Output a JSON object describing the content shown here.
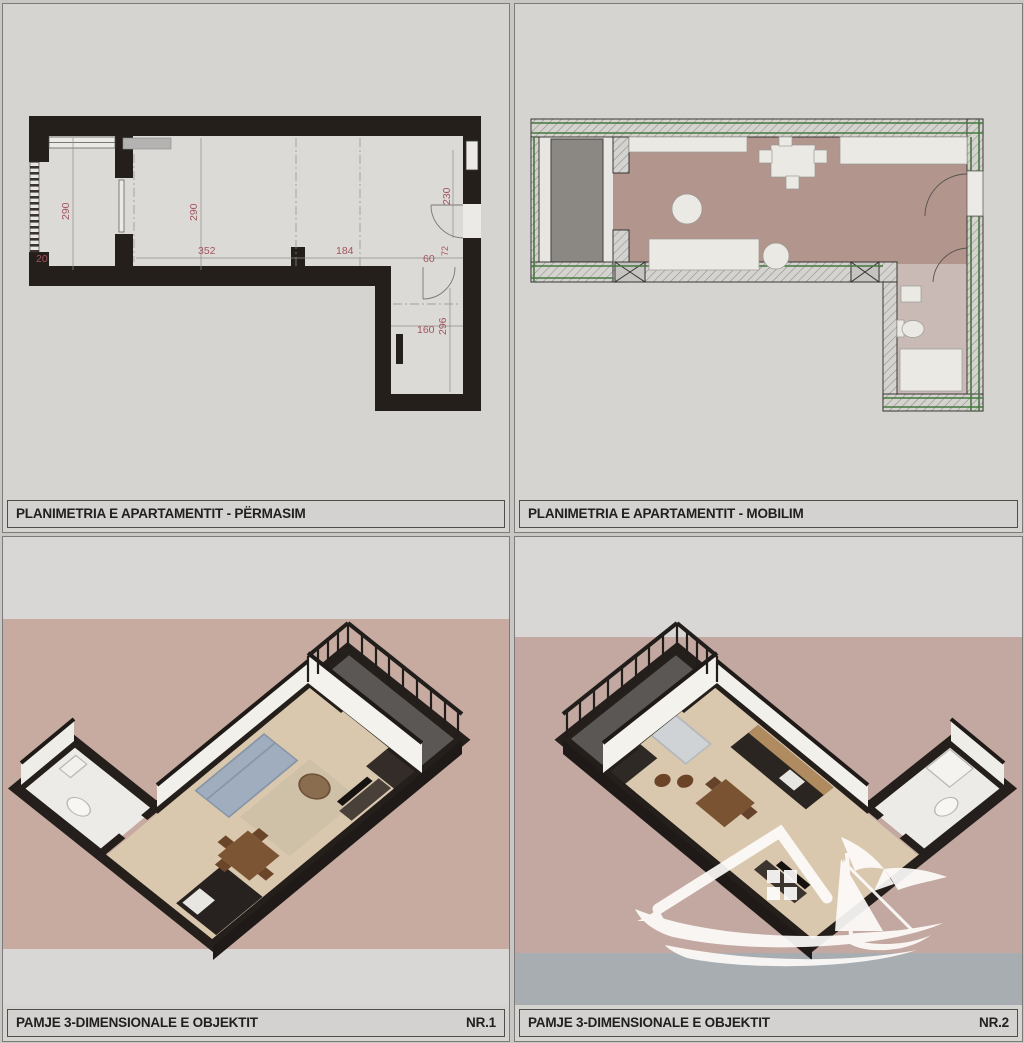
{
  "panels": {
    "top_left": {
      "label": "PLANIMETRIA E APARTAMENTIT - PËRMASIM"
    },
    "top_right": {
      "label": "PLANIMETRIA E APARTAMENTIT - MOBILIM"
    },
    "bottom_left": {
      "label": "PAMJE 3-DIMENSIONALE E OBJEKTIT",
      "number": "NR.1"
    },
    "bottom_right": {
      "label": "PAMJE 3-DIMENSIONALE E OBJEKTIT",
      "number": "NR.2"
    }
  },
  "plan_dims": {
    "balcony_h": "290",
    "balcony_w": "20",
    "living_h": "290",
    "living_w": "352",
    "hall_w": "184",
    "entry_h": "230",
    "entry_door_w": "60",
    "entry_door_d": "72",
    "bath_w": "160",
    "bath_h": "296"
  },
  "colors": {
    "wall_black": "#251f1c",
    "dim_red": "#a4545e",
    "dim_line": "#8f8d8a",
    "green_insulation": "#45793f",
    "furnished_floor": "#b2958d",
    "bath_marble": "#c9bab6",
    "balcony_deck": "#8b8782",
    "render_bg_mauve": "#c7aba1",
    "strip_gray": "#d9d7d5",
    "strip_bluegray": "#a8adb1",
    "wood_floor": "#d9c8ae",
    "sofa_blue_gray": "#9fadbe",
    "wood_brown": "#7c5634",
    "watermark_white": "#fdfcfa"
  },
  "watermark": {
    "name": "house-sailboat-seagull-logo"
  }
}
